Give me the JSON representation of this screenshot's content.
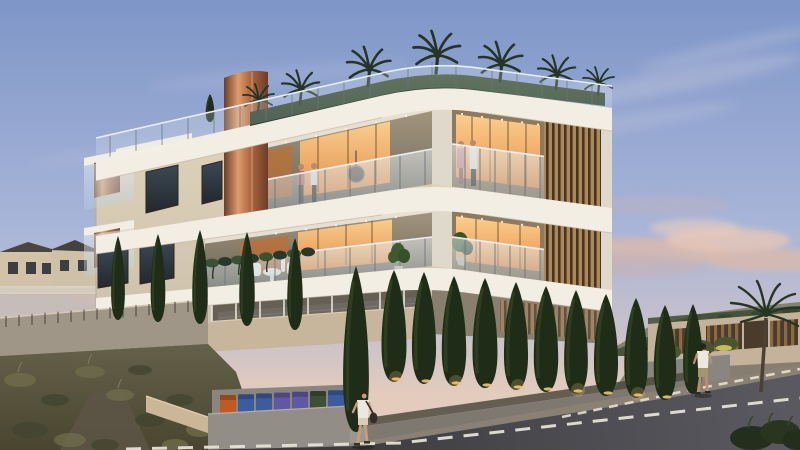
{
  "meta": {
    "scene": "Dusk photorealistic 3D architectural rendering of a modern three-storey apartment building with curved white fascia bands, copper column accents, wooden louver screens, roof garden with palm trees, warm-lit balconies with residents, cypress tree hedge row, stone retaining walls, recycling bins, a street with dashed white lane markings and two pedestrians",
    "image_type": "architectural-render",
    "visible_text": "none"
  },
  "scene_inventory": {
    "building_floors_visible": 3,
    "roof_palm_trees": 7,
    "front_cypress_row_count": 11,
    "left_cypress_group_count": 5,
    "residents_on_balconies": 4,
    "pedestrians": [
      "woman walking with shoulder bag (foreground sidewalk)",
      "man walking (right sidewalk)"
    ],
    "vehicles": [
      "white van parked under building",
      "dark car parked under building"
    ],
    "bins_left_to_right": [
      "orange",
      "blue",
      "blue",
      "purple",
      "purple",
      "green",
      "blue"
    ],
    "road_markings": "dashed white lane edge lines",
    "time_of_day": "dusk"
  },
  "palette": {
    "sky_top": "#7E96C8",
    "sky_mid": "#A8B5D8",
    "sky_low": "#C8C1CB",
    "sky_horizon": "#E4CCBD",
    "cloud_white": "#F3EDEB",
    "cloud_pink": "#DEB9A8",
    "cloud_gray": "#C2B2BA",
    "hill_far": "#7F7F6B",
    "hill_green": "#49553A",
    "hill_dark": "#3A462E",
    "house_wall": "#D2C3A8",
    "house_roof": "#4A4540",
    "face_left_hi": "#E2D6BF",
    "face_left_lo": "#CCC0AA",
    "face_right_hi": "#E9DBC3",
    "face_right_lo": "#D5C7AF",
    "fascia": "#F2EEE3",
    "fascia_shade": "#DED9CB",
    "recess_hi": "#A3977F",
    "recess_lo": "#6E6455",
    "interior_back": "#8F7A5E",
    "window_dark_hi": "#3C4953",
    "window_dark_lo": "#22282E",
    "frame": "#2B261F",
    "warm_hi": "#FFD08F",
    "warm_lo": "#E8924A",
    "warm_deep": "#BF6F33",
    "glass_hi": "#EDF3F7",
    "glass_lo": "#B9CEDC",
    "rail_post": "#6A737C",
    "rail_top": "#E8EFF3",
    "copper_light": "#DD9C6E",
    "copper_mid": "#B06A42",
    "copper_dark": "#6B3D27",
    "louver_light": "#AC8757",
    "louver_dark": "#463424",
    "hedge_hi": "#3A5134",
    "hedge_lo": "#26392A",
    "palm": "#243426",
    "cypress": "#1F2D18",
    "cypress_lit": "#3B5527",
    "uplight": "#F5C473",
    "shrub_glow": "#E3D76A",
    "shrub": "#49552C",
    "wall_lit": "#C7B69C",
    "wall_lit2": "#CBB797",
    "wall_mid": "#A09687",
    "wall_gray": "#8A857E",
    "wall_front": "#928D86",
    "wall_dark": "#6F695F",
    "scrub_hi": "#64614A",
    "scrub_lo": "#49462F",
    "scrub_tuft": "#6E6B4B",
    "scrub_dark": "#434530",
    "dirt": "#5D5546",
    "pave": "#8A8174",
    "pave_dark": "#837B6E",
    "road_hi": "#59595F",
    "road_lo": "#3A3A3E",
    "marking": "#E6E1D5",
    "bin_orange": "#BF5A22",
    "bin_blue": "#3D5CA0",
    "bin_purple": "#6058A2",
    "bin_green": "#3C5038",
    "van": "#D8D5CE",
    "car_dark": "#43444A",
    "glass_dark": "#2A2D33",
    "skin": "#C79A78",
    "shirt_white": "#ECE8E1",
    "shorts_light": "#D9CDB4",
    "shorts_khaki": "#A8946C",
    "hair": "#2A221B",
    "bag": "#322D27",
    "sofa": "#6E6A63",
    "enclosure_dark": "#5F594E",
    "post_white": "#ECEADE",
    "trunk": "#4A4034",
    "metal": "#3E3B35",
    "steps": "#D9D2C4"
  }
}
